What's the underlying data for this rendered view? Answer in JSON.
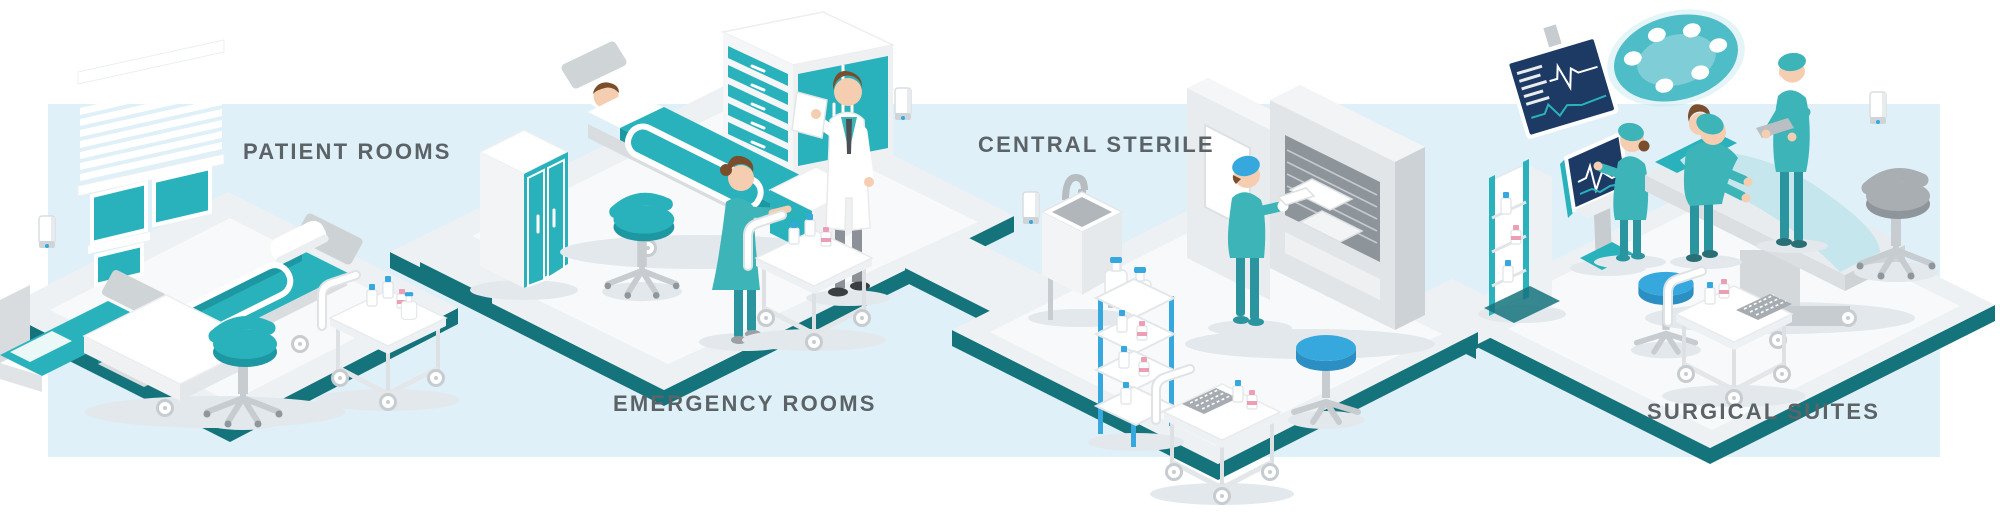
{
  "title": "Hospital departments isometric workflow illustration",
  "scenes": [
    {
      "id": "patient-rooms",
      "label": "PATIENT ROOMS",
      "items": [
        "window-blinds",
        "hospital-bed",
        "second-hospital-bed",
        "overbed-table",
        "supply-cart",
        "rolling-stool",
        "hand-sanitizer-dispenser"
      ]
    },
    {
      "id": "emergency-rooms",
      "label": "EMERGENCY ROOMS",
      "items": [
        "patient-in-bed",
        "bed-rail",
        "wardrobe-cabinet",
        "drawer-cabinet",
        "doctor-with-chart",
        "nurse-at-cart",
        "supply-cart",
        "rolling-stool",
        "hand-sanitizer-dispenser"
      ]
    },
    {
      "id": "central-sterile",
      "label": "CENTRAL STERILE",
      "items": [
        "scrub-sink",
        "soap-dispenser",
        "sterilizer-unit",
        "technician-loading-trays",
        "supply-shelf",
        "solution-jugs",
        "instrument-cart",
        "round-stool"
      ]
    },
    {
      "id": "surgical-suites",
      "label": "SURGICAL SUITES",
      "items": [
        "vital-signs-monitor",
        "surgical-lamp",
        "anesthesia-console",
        "operating-table",
        "patient-under-drape",
        "surgeon",
        "scrub-nurse",
        "observing-surgeon",
        "supply-shelf",
        "instrument-cart",
        "round-stool",
        "saddle-stool",
        "hand-sanitizer-dispenser"
      ]
    }
  ],
  "palette": {
    "band": "#dff0f8",
    "floor": "#eef1f3",
    "floor_inset": "#f8fafb",
    "edge": "#15737c",
    "teal_primary": "#29b2bb",
    "teal_dark": "#1d97a1",
    "scrub": "#3cb4b8",
    "scrub_dark": "#2a959e",
    "blue_accent": "#37a8dd",
    "blue_dark": "#2b8fc3",
    "navy": "#1d3a64",
    "sheet": "#c5e6ec",
    "gray_light": "#e6e9eb",
    "gray_mid": "#c7ccd0",
    "gray_dark": "#8f979c",
    "skin": "#f5cdb0",
    "hair": "#7a4e2c",
    "white": "#ffffff",
    "pink": "#ec9fb4",
    "shadow": "#e2e8ec",
    "label": "#5b6367"
  }
}
